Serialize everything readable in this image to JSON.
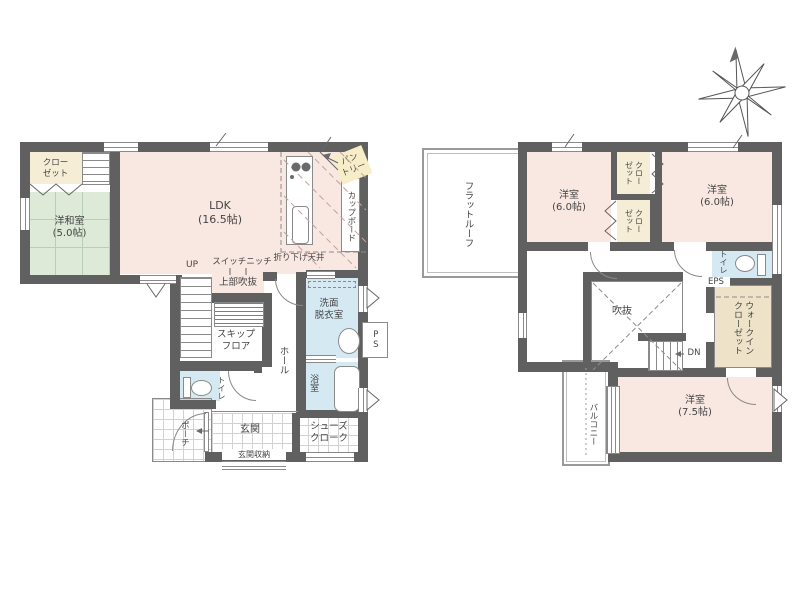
{
  "title": "2-story house floor plan",
  "colors": {
    "wall": "#606060",
    "line": "#8a8a8a",
    "room_pink": "#f9e7e1",
    "tatami_green": "#dcead7",
    "tatami_line": "#b9ceb4",
    "closet_cream": "#f6edd6",
    "wic_beige": "#eee3c8",
    "wet_blue": "#d5e9f2",
    "tile_line": "#d2d2d2",
    "pantry_highlight": "#f8edc9",
    "text": "#454545"
  },
  "floor1": {
    "closet_label": "クロー\nゼット",
    "japanese_room_label": "洋和室\n(5.0帖)",
    "ldk_label": "LDK\n(16.5帖)",
    "pantry_label": "パン\nトリー",
    "cupboard_label": "カップボード",
    "dropped_ceiling_label": "折り下げ天井",
    "switch_niche_label": "スイッチニッチ",
    "up_label": "UP",
    "open_above_label": "上部吹抜",
    "skip_floor_label": "スキップ\nフロア",
    "hall_label": "ホール",
    "washroom_label": "洗面\n脱衣室",
    "ps_label": "PS",
    "bath_label": "浴室",
    "toilet_label": "トイレ",
    "porch_label": "ポーチ",
    "entrance_label": "玄関",
    "entrance_storage_label": "玄関収納",
    "shoe_cloak_label": "シューズ\nクローク"
  },
  "floor2": {
    "flat_roof_label": "フラットルーフ",
    "bedroom_a_label": "洋室\n(6.0帖)",
    "bedroom_b_label": "洋室\n(6.0帖)",
    "closet_a_label": "クロー\nゼット",
    "closet_b_label": "クロー\nゼット",
    "toilet_label": "トイレ",
    "eps_label": "EPS",
    "void_label": "吹抜",
    "down_label": "DN",
    "walk_in_closet_label": "ウォークイン\nクローゼット",
    "balcony_label": "バルコニー",
    "bedroom_c_label": "洋室\n(7.5帖)"
  }
}
